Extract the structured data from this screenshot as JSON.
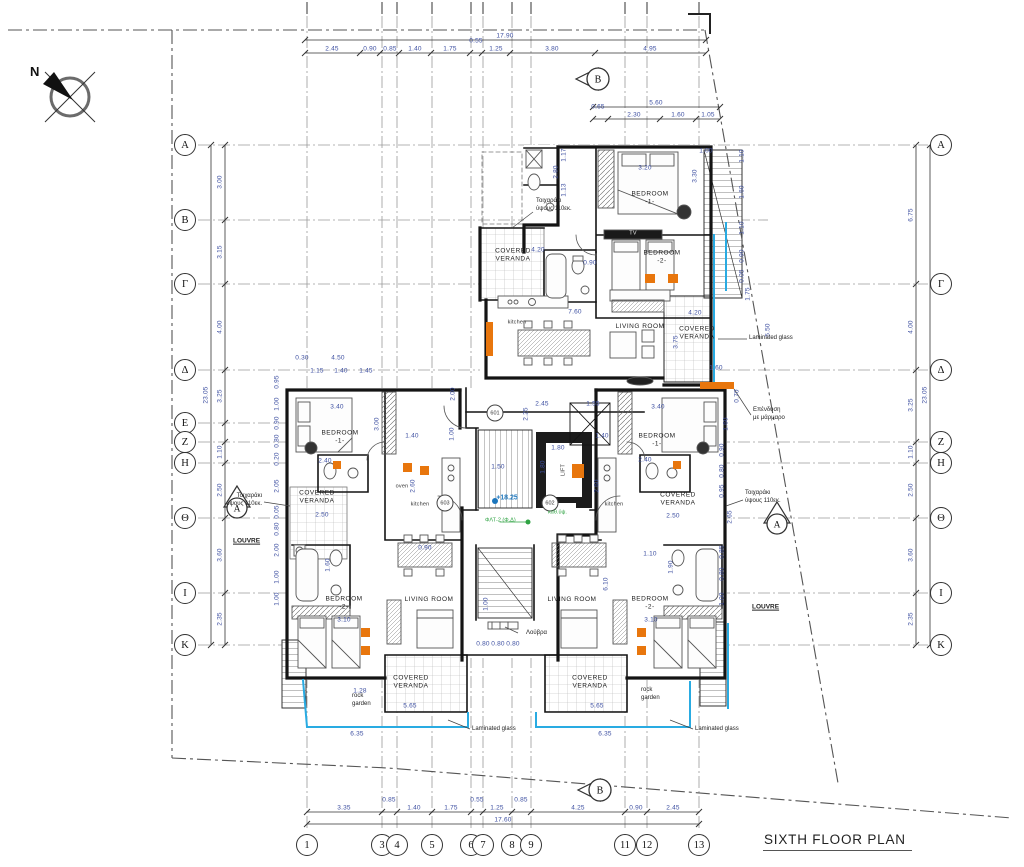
{
  "meta": {
    "title": "SIXTH FLOOR PLAN",
    "north_label": "N"
  },
  "colors": {
    "wall": "#141414",
    "dim_text": "#3d4fa1",
    "laminated_glass": "#29abe2",
    "accent_orange": "#e8760d",
    "green_note": "#2fa343",
    "level_blue": "#1b75bc",
    "grid_line": "#9a9a9a",
    "boundary": "#555"
  },
  "grid": {
    "rows": [
      {
        "label": "A",
        "y": 145,
        "sides": "both"
      },
      {
        "label": "B",
        "y": 220,
        "sides": "left"
      },
      {
        "label": "Γ",
        "y": 284,
        "sides": "both"
      },
      {
        "label": "Δ",
        "y": 370,
        "sides": "both"
      },
      {
        "label": "E",
        "y": 423,
        "sides": "left"
      },
      {
        "label": "Z",
        "y": 442,
        "sides": "both"
      },
      {
        "label": "H",
        "y": 463,
        "sides": "both"
      },
      {
        "label": "Θ",
        "y": 518,
        "sides": "both"
      },
      {
        "label": "I",
        "y": 593,
        "sides": "both"
      },
      {
        "label": "K",
        "y": 645,
        "sides": "both"
      }
    ],
    "cols": [
      {
        "label": "1",
        "x": 307
      },
      {
        "label": "3",
        "x": 382
      },
      {
        "label": "4",
        "x": 397
      },
      {
        "label": "5",
        "x": 432
      },
      {
        "label": "6",
        "x": 471
      },
      {
        "label": "7",
        "x": 483
      },
      {
        "label": "8",
        "x": 512
      },
      {
        "label": "9",
        "x": 531
      },
      {
        "label": "11",
        "x": 625
      },
      {
        "label": "12",
        "x": 647
      },
      {
        "label": "13",
        "x": 699
      }
    ]
  },
  "dim_chains": [
    {
      "o": "h",
      "y": 40,
      "a": 305,
      "b": 706,
      "ticks": [
        305,
        706
      ],
      "labels": [
        {
          "t": "17.90",
          "p": 505
        }
      ]
    },
    {
      "o": "h",
      "y": 53,
      "a": 305,
      "b": 706,
      "ticks": [
        305,
        360,
        380,
        399,
        431,
        470,
        482,
        510,
        595,
        706
      ],
      "labels": [
        {
          "t": "2.45",
          "p": 332
        },
        {
          "t": "0.90",
          "p": 370
        },
        {
          "t": "0.85",
          "p": 390
        },
        {
          "t": "1.40",
          "p": 415
        },
        {
          "t": "1.75",
          "p": 450
        },
        {
          "t": "0.55",
          "p": 476,
          "dy": -8
        },
        {
          "t": "1.25",
          "p": 496
        },
        {
          "t": "3.80",
          "p": 552
        },
        {
          "t": "4.95",
          "p": 650
        }
      ]
    },
    {
      "o": "h",
      "y": 107,
      "a": 593,
      "b": 720,
      "ticks": [
        593,
        720
      ],
      "labels": [
        {
          "t": "5.60",
          "p": 656
        }
      ]
    },
    {
      "o": "h",
      "y": 119,
      "a": 593,
      "b": 720,
      "ticks": [
        593,
        608,
        660,
        696,
        720
      ],
      "labels": [
        {
          "t": "0.65",
          "p": 598,
          "dy": -8
        },
        {
          "t": "2.30",
          "p": 634
        },
        {
          "t": "1.60",
          "p": 678
        },
        {
          "t": "1.05",
          "p": 708
        }
      ]
    },
    {
      "o": "h",
      "y": 812,
      "a": 307,
      "b": 699,
      "ticks": [
        307,
        382,
        397,
        432,
        471,
        483,
        512,
        531,
        625,
        647,
        699
      ],
      "labels": [
        {
          "t": "3.35",
          "p": 344
        },
        {
          "t": "0.85",
          "p": 389,
          "dy": -8
        },
        {
          "t": "1.40",
          "p": 414
        },
        {
          "t": "1.75",
          "p": 451
        },
        {
          "t": "0.55",
          "p": 477,
          "dy": -8
        },
        {
          "t": "1.25",
          "p": 497
        },
        {
          "t": "0.85",
          "p": 521,
          "dy": -8
        },
        {
          "t": "4.25",
          "p": 578
        },
        {
          "t": "0.90",
          "p": 636
        },
        {
          "t": "2.45",
          "p": 673
        }
      ]
    },
    {
      "o": "h",
      "y": 824,
      "a": 307,
      "b": 699,
      "ticks": [
        307,
        699
      ],
      "labels": [
        {
          "t": "17.60",
          "p": 503
        }
      ]
    },
    {
      "o": "v",
      "x": 225,
      "a": 145,
      "b": 645,
      "ticks": [
        145,
        220,
        284,
        370,
        423,
        442,
        463,
        518,
        593,
        645
      ],
      "labels": [
        {
          "t": "3.00",
          "p": 182
        },
        {
          "t": "3.15",
          "p": 252
        },
        {
          "t": "4.00",
          "p": 327
        },
        {
          "t": "3.25",
          "p": 396
        },
        {
          "t": "1.10",
          "p": 452
        },
        {
          "t": "2.50",
          "p": 490
        },
        {
          "t": "3.60",
          "p": 555
        },
        {
          "t": "2.35",
          "p": 619
        }
      ]
    },
    {
      "o": "v",
      "x": 211,
      "a": 145,
      "b": 645,
      "ticks": [
        145,
        645
      ],
      "labels": [
        {
          "t": "23.05",
          "p": 395
        }
      ]
    },
    {
      "o": "v",
      "x": 916,
      "a": 145,
      "b": 645,
      "ticks": [
        145,
        284,
        370,
        442,
        463,
        518,
        593,
        645
      ],
      "labels": [
        {
          "t": "6.75",
          "p": 215
        },
        {
          "t": "4.00",
          "p": 327
        },
        {
          "t": "3.25",
          "p": 405
        },
        {
          "t": "1.10",
          "p": 452
        },
        {
          "t": "2.50",
          "p": 490
        },
        {
          "t": "3.60",
          "p": 555
        },
        {
          "t": "2.35",
          "p": 619
        }
      ]
    },
    {
      "o": "v",
      "x": 930,
      "a": 145,
      "b": 645,
      "ticks": [
        145,
        645
      ],
      "labels": [
        {
          "t": "23.05",
          "p": 395
        }
      ]
    }
  ],
  "dim_labels": [
    {
      "t": "3.20",
      "x": 645,
      "y": 168
    },
    {
      "t": "3.30",
      "x": 695,
      "y": 176,
      "v": 1
    },
    {
      "t": "1.00",
      "x": 706,
      "y": 151
    },
    {
      "t": "1.17",
      "x": 564,
      "y": 155,
      "v": 1
    },
    {
      "t": "2.80",
      "x": 556,
      "y": 172,
      "v": 1
    },
    {
      "t": "1.13",
      "x": 564,
      "y": 190,
      "v": 1
    },
    {
      "t": "1.10",
      "x": 742,
      "y": 156,
      "v": 1
    },
    {
      "t": "1.60",
      "x": 742,
      "y": 192,
      "v": 1
    },
    {
      "t": "1.10",
      "x": 742,
      "y": 228,
      "v": 1
    },
    {
      "t": "0.90",
      "x": 742,
      "y": 256,
      "v": 1
    },
    {
      "t": "0.05",
      "x": 742,
      "y": 276,
      "v": 1
    },
    {
      "t": "1.75",
      "x": 748,
      "y": 294,
      "v": 1
    },
    {
      "t": "5.50",
      "x": 768,
      "y": 330,
      "v": 1
    },
    {
      "t": "1.60",
      "x": 716,
      "y": 368
    },
    {
      "t": "0.70",
      "x": 737,
      "y": 396,
      "v": 1
    },
    {
      "t": "1.60",
      "x": 726,
      "y": 424,
      "v": 1
    },
    {
      "t": "4.20",
      "x": 538,
      "y": 250
    },
    {
      "t": "0.90",
      "x": 590,
      "y": 263
    },
    {
      "t": "7.60",
      "x": 575,
      "y": 312
    },
    {
      "t": "4.20",
      "x": 695,
      "y": 313
    },
    {
      "t": "3.75",
      "x": 676,
      "y": 342,
      "v": 1
    },
    {
      "t": "2.45",
      "x": 542,
      "y": 404
    },
    {
      "t": "1.55",
      "x": 593,
      "y": 404
    },
    {
      "t": "2.25",
      "x": 526,
      "y": 414,
      "v": 1
    },
    {
      "t": "2.00",
      "x": 453,
      "y": 394,
      "v": 1
    },
    {
      "t": "1.00",
      "x": 452,
      "y": 434,
      "v": 1
    },
    {
      "t": "1.80",
      "x": 558,
      "y": 448
    },
    {
      "t": "1.80",
      "x": 543,
      "y": 467,
      "v": 1
    },
    {
      "t": "1.50",
      "x": 498,
      "y": 467
    },
    {
      "t": "1.00",
      "x": 486,
      "y": 604,
      "v": 1
    },
    {
      "t": "0.80",
      "x": 483,
      "y": 644
    },
    {
      "t": "0.80",
      "x": 498,
      "y": 644
    },
    {
      "t": "0.80",
      "x": 513,
      "y": 644
    },
    {
      "t": "0.30",
      "x": 302,
      "y": 358
    },
    {
      "t": "4.50",
      "x": 338,
      "y": 358
    },
    {
      "t": "1.15",
      "x": 317,
      "y": 371
    },
    {
      "t": "1.40",
      "x": 341,
      "y": 371
    },
    {
      "t": "1.45",
      "x": 366,
      "y": 371
    },
    {
      "t": "3.40",
      "x": 337,
      "y": 407
    },
    {
      "t": "3.00",
      "x": 377,
      "y": 424,
      "v": 1
    },
    {
      "t": "1.40",
      "x": 412,
      "y": 436
    },
    {
      "t": "2.40",
      "x": 325,
      "y": 461
    },
    {
      "t": "2.50",
      "x": 322,
      "y": 515
    },
    {
      "t": "2.60",
      "x": 413,
      "y": 486,
      "v": 1
    },
    {
      "t": "0.90",
      "x": 425,
      "y": 548
    },
    {
      "t": "1.60",
      "x": 328,
      "y": 565,
      "v": 1
    },
    {
      "t": "3.10",
      "x": 344,
      "y": 620
    },
    {
      "t": "1.28",
      "x": 360,
      "y": 691
    },
    {
      "t": "5.65",
      "x": 410,
      "y": 706
    },
    {
      "t": "6.35",
      "x": 357,
      "y": 734
    },
    {
      "t": "3.40",
      "x": 658,
      "y": 407
    },
    {
      "t": "1.40",
      "x": 602,
      "y": 436
    },
    {
      "t": "2.40",
      "x": 645,
      "y": 460
    },
    {
      "t": "2.50",
      "x": 673,
      "y": 516
    },
    {
      "t": "2.60",
      "x": 597,
      "y": 486,
      "v": 1
    },
    {
      "t": "1.10",
      "x": 650,
      "y": 554
    },
    {
      "t": "1.90",
      "x": 671,
      "y": 567,
      "v": 1
    },
    {
      "t": "6.10",
      "x": 606,
      "y": 584,
      "v": 1
    },
    {
      "t": "3.10",
      "x": 651,
      "y": 620
    },
    {
      "t": "5.65",
      "x": 597,
      "y": 706
    },
    {
      "t": "6.35",
      "x": 605,
      "y": 734
    },
    {
      "t": "0.95",
      "x": 277,
      "y": 382,
      "v": 1
    },
    {
      "t": "1.00",
      "x": 277,
      "y": 404,
      "v": 1
    },
    {
      "t": "0.90",
      "x": 277,
      "y": 423,
      "v": 1
    },
    {
      "t": "0.80",
      "x": 277,
      "y": 441,
      "v": 1
    },
    {
      "t": "0.20",
      "x": 277,
      "y": 459,
      "v": 1
    },
    {
      "t": "2.05",
      "x": 277,
      "y": 486,
      "v": 1
    },
    {
      "t": "0.05",
      "x": 277,
      "y": 512,
      "v": 1
    },
    {
      "t": "0.80",
      "x": 277,
      "y": 529,
      "v": 1
    },
    {
      "t": "2.00",
      "x": 277,
      "y": 550,
      "v": 1
    },
    {
      "t": "1.00",
      "x": 277,
      "y": 577,
      "v": 1
    },
    {
      "t": "1.00",
      "x": 277,
      "y": 599,
      "v": 1
    },
    {
      "t": "0.90",
      "x": 722,
      "y": 450,
      "v": 1
    },
    {
      "t": "0.80",
      "x": 722,
      "y": 471,
      "v": 1
    },
    {
      "t": "0.95",
      "x": 722,
      "y": 491,
      "v": 1
    },
    {
      "t": "2.65",
      "x": 730,
      "y": 517,
      "v": 1
    },
    {
      "t": "0.85",
      "x": 722,
      "y": 552,
      "v": 1
    },
    {
      "t": "0.80",
      "x": 722,
      "y": 574,
      "v": 1
    },
    {
      "t": "1.00",
      "x": 722,
      "y": 599,
      "v": 1
    }
  ],
  "rooms": [
    {
      "lines": [
        "BEDROOM",
        "-1-"
      ],
      "x": 650,
      "y": 199
    },
    {
      "lines": [
        "BEDROOM",
        "-2-"
      ],
      "x": 662,
      "y": 258
    },
    {
      "lines": [
        "LIVING ROOM"
      ],
      "x": 640,
      "y": 327
    },
    {
      "lines": [
        "kitchen"
      ],
      "x": 517,
      "y": 323,
      "sm": 1
    },
    {
      "lines": [
        "COVERED",
        "VERANDA"
      ],
      "x": 513,
      "y": 256
    },
    {
      "lines": [
        "COVERED",
        "VERANDA"
      ],
      "x": 697,
      "y": 334
    },
    {
      "lines": [
        "TV"
      ],
      "x": 633,
      "y": 234,
      "sm": 1,
      "w": 1
    },
    {
      "lines": [
        "BEDROOM",
        "-1-"
      ],
      "x": 340,
      "y": 438
    },
    {
      "lines": [
        "COVERED",
        "VERANDA"
      ],
      "x": 317,
      "y": 498
    },
    {
      "lines": [
        "kitchen"
      ],
      "x": 420,
      "y": 505,
      "sm": 1
    },
    {
      "lines": [
        "oven"
      ],
      "x": 402,
      "y": 487,
      "sm": 1
    },
    {
      "lines": [
        "LIVING ROOM"
      ],
      "x": 429,
      "y": 600
    },
    {
      "lines": [
        "BEDROOM",
        "-2-"
      ],
      "x": 344,
      "y": 604
    },
    {
      "lines": [
        "COVERED",
        "VERANDA"
      ],
      "x": 411,
      "y": 683
    },
    {
      "lines": [
        "BEDROOM",
        "-1-"
      ],
      "x": 657,
      "y": 441
    },
    {
      "lines": [
        "COVERED",
        "VERANDA"
      ],
      "x": 678,
      "y": 500
    },
    {
      "lines": [
        "kitchen"
      ],
      "x": 614,
      "y": 505,
      "sm": 1
    },
    {
      "lines": [
        "LIVING ROOM"
      ],
      "x": 572,
      "y": 600
    },
    {
      "lines": [
        "BEDROOM",
        "-2-"
      ],
      "x": 650,
      "y": 604
    },
    {
      "lines": [
        "COVERED",
        "VERANDA"
      ],
      "x": 590,
      "y": 683
    },
    {
      "lines": [
        "LIFT"
      ],
      "x": 564,
      "y": 470,
      "sm": 1,
      "vert": 1
    }
  ],
  "unit_tags": [
    {
      "t": "601",
      "x": 495,
      "y": 413
    },
    {
      "t": "602",
      "x": 550,
      "y": 503
    },
    {
      "t": "603",
      "x": 445,
      "y": 503
    }
  ],
  "section_markers": [
    {
      "t": "B",
      "x": 598,
      "y": 79,
      "dir": "left"
    },
    {
      "t": "B",
      "x": 600,
      "y": 790,
      "dir": "left"
    },
    {
      "t": "A",
      "x": 237,
      "y": 505,
      "dir": "up"
    },
    {
      "t": "A",
      "x": 777,
      "y": 521,
      "dir": "up"
    }
  ],
  "level_marker": {
    "t": "+18.25",
    "x": 507,
    "y": 498
  },
  "annotations": [
    {
      "lines": [
        "Τοιχαράκι",
        "ύψους 110εκ."
      ],
      "x": 536,
      "y": 205
    },
    {
      "lines": [
        "Τοιχαράκι",
        "ύψους 110εκ."
      ],
      "x": 262,
      "y": 500,
      "right": 1
    },
    {
      "lines": [
        "Τοιχαράκι",
        "ύψους 110εκ."
      ],
      "x": 745,
      "y": 497
    },
    {
      "lines": [
        "Laminated glass"
      ],
      "x": 749,
      "y": 338
    },
    {
      "lines": [
        "Laminated glass"
      ],
      "x": 472,
      "y": 729
    },
    {
      "lines": [
        "Laminated glass"
      ],
      "x": 695,
      "y": 729
    },
    {
      "lines": [
        "Επένδυση",
        "με μάρμαρο"
      ],
      "x": 753,
      "y": 414
    },
    {
      "lines": [
        "LOUVRE"
      ],
      "x": 233,
      "y": 542,
      "u": 1,
      "b": 1
    },
    {
      "lines": [
        "LOUVRE"
      ],
      "x": 752,
      "y": 608,
      "u": 1,
      "b": 1
    },
    {
      "lines": [
        "Λούβρα"
      ],
      "x": 526,
      "y": 633
    },
    {
      "lines": [
        "rock",
        "garden"
      ],
      "x": 352,
      "y": 700,
      "g0": 1
    },
    {
      "lines": [
        "rock",
        "garden"
      ],
      "x": 641,
      "y": 694,
      "g0": 1
    },
    {
      "lines": [
        "ΦΛΤ-2 (Φ.Δ)"
      ],
      "x": 485,
      "y": 521,
      "g": 1
    },
    {
      "lines": [
        "καθ.ύψ."
      ],
      "x": 548,
      "y": 513,
      "g": 1
    }
  ]
}
